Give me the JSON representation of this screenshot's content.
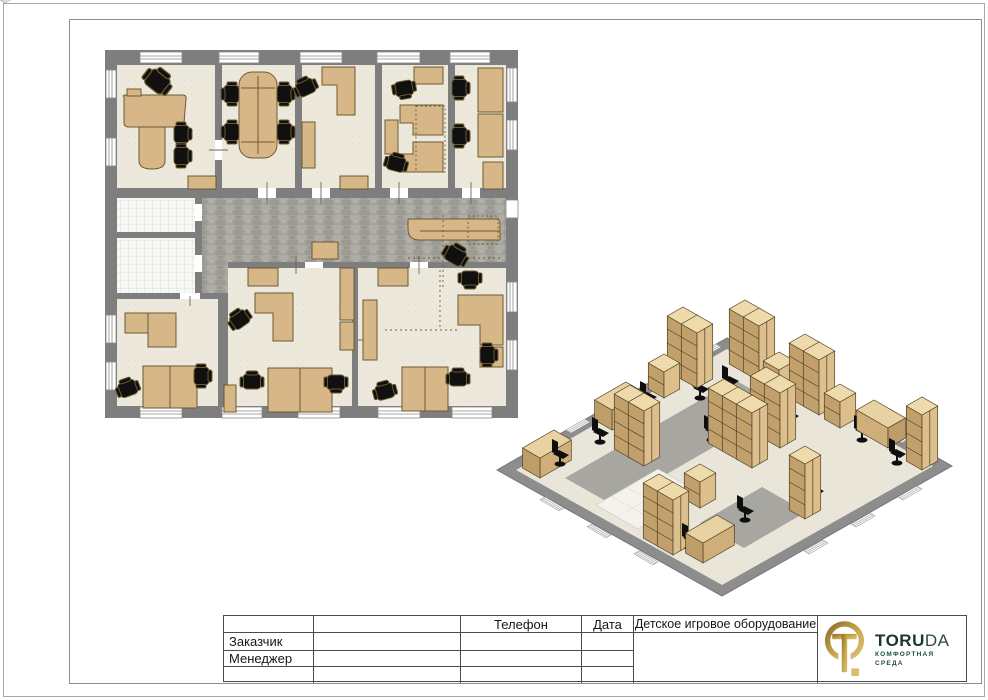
{
  "title_block": {
    "phone_label": "Телефон",
    "date_label": "Дата",
    "project_title": "Детское игровое оборудование",
    "customer_label": "Заказчик",
    "manager_label": "Менеджер"
  },
  "logo": {
    "brand_bold": "TORU",
    "brand_light": "DA",
    "tagline_line1": "КОМФОРТНАЯ",
    "tagline_line2": "СРЕДА",
    "gold": "#b6913c",
    "green": "#1c4a3a"
  },
  "colors": {
    "wall_gray": "#7e7e7e",
    "room_floor": "#ece9dc",
    "corridor_floor": "#a4a39c",
    "tile_floor": "#f8f8f5",
    "furniture_tan": "#d7b787",
    "furniture_outline": "#6d5a30",
    "chair_black": "#101010",
    "frame_gray": "#8f8f8f",
    "iso_cabinet_light": "#dcbf8d",
    "iso_cabinet_dark": "#c2a06c",
    "iso_cabinet_top": "#eedaab"
  }
}
